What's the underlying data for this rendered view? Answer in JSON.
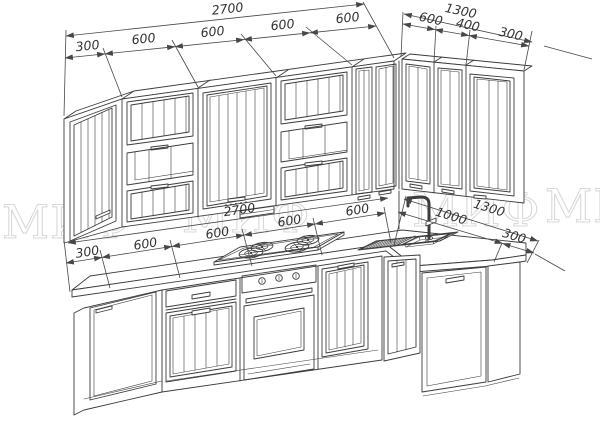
{
  "title": "Kitchen layout technical drawing",
  "watermark": {
    "text": "МИФ"
  },
  "dims": {
    "upper_left": {
      "total": "2700",
      "segments": [
        "300",
        "600",
        "600",
        "600",
        "600"
      ]
    },
    "upper_right": {
      "total": "1300",
      "segments": [
        "600",
        "400",
        "300"
      ]
    },
    "lower_left": {
      "total": "2700",
      "segments": [
        "300",
        "600",
        "600",
        "600",
        "600"
      ]
    },
    "lower_right": {
      "total": "1300",
      "segments": [
        "1000",
        "300"
      ]
    }
  },
  "colors": {
    "line": "#3c3c3c",
    "dimension": "#474747",
    "dim_text": "#333333",
    "watermark": "#d9d9d9",
    "background": "#ffffff"
  }
}
